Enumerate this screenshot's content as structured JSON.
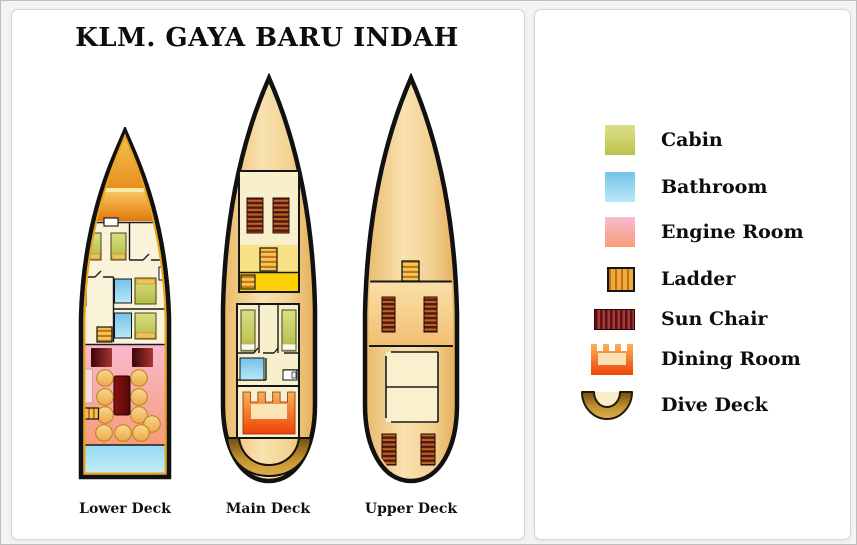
{
  "title": "KLM. GAYA BARU INDAH",
  "decks": [
    {
      "name": "lower-deck",
      "label": "Lower Deck"
    },
    {
      "name": "main-deck",
      "label": "Main Deck"
    },
    {
      "name": "upper-deck",
      "label": "Upper Deck"
    }
  ],
  "legend": {
    "items": [
      {
        "name": "cabin",
        "label": "Cabin",
        "icon": "cabin-icon",
        "color": "#bcc24a"
      },
      {
        "name": "bathroom",
        "label": "Bathroom",
        "icon": "bathroom-icon",
        "color": "#74c2e9"
      },
      {
        "name": "engine-room",
        "label": "Engine Room",
        "icon": "engine-room-icon",
        "color": "#f89c79"
      },
      {
        "name": "ladder",
        "label": "Ladder",
        "icon": "ladder-icon",
        "color": "#f2a93b"
      },
      {
        "name": "sun-chair",
        "label": "Sun Chair",
        "icon": "sun-chair-icon",
        "color": "#5f1111"
      },
      {
        "name": "dining-room",
        "label": "Dining Room",
        "icon": "dining-room-icon",
        "color": "#ee4206"
      },
      {
        "name": "dive-deck",
        "label": "Dive Deck",
        "icon": "dive-deck-icon",
        "color": "#b07f22"
      }
    ]
  }
}
